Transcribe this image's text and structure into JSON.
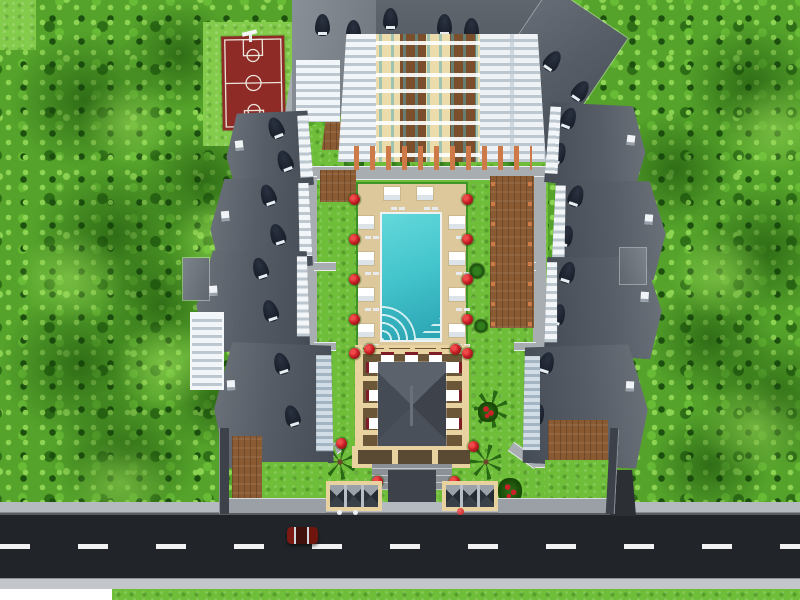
{
  "scene": {
    "title": "Aerial 3D render of a gated residential complex",
    "description": "Top-down architectural visualization: seven dark-roofed apartment blocks arranged around a landscaped courtyard with a turquoise swimming pool, white sun loungers, red flower planters, a clubhouse pavilion ringed by a beige colonnade with tables, palm trees, two pyramid-roofed entrance pergola gates, a basketball court and a small playground among dense trees, bordered at the bottom by an asphalt street with a dashed center line and a single dark-red car.",
    "style": "3d-render",
    "time_of_day": "daytime"
  },
  "colors": {
    "foliage_base": "#55a32b",
    "foliage_light": "#8ed453",
    "foliage_mid": "#67bb35",
    "foliage_dark": "#2e6e16",
    "foliage_deep": "#1d5110",
    "grass": "#6fbe3a",
    "grass_light": "#83cb4a",
    "court_red": "#8f2b26",
    "court_line": "#ece7dc",
    "roof_dark": "#575d66",
    "dormer": "#1a202b",
    "facade_cream": "#ecdcab",
    "facade_brown": "#7b4f2b",
    "facade_shadow": "#bcc7d0",
    "terracotta": "#cd7a48",
    "wood": "#8a5a33",
    "pool_deck": "#dcc89a",
    "deck_edge": "#3f9428",
    "pool_water": "#45c6cd",
    "pool_water_deep": "#2aa3b2",
    "path": "#a8adb2",
    "path_edge": "#e9ebee",
    "beige": "#e8d2a0",
    "maroon": "#7e1d26",
    "flower": "#cc2128",
    "flower_dark": "#7e1313",
    "road": "#212529",
    "road_line": "#f2f2f2",
    "sidewalk": "#b5bac0",
    "sidewalk_light": "#c3c7cc",
    "wall": "#9aa0a6",
    "wall_dark": "#3d424a",
    "car": "#6f150e",
    "white": "#ffffff"
  },
  "objects": {
    "basketball_court": {
      "location": "top-left",
      "surface_color": "#8f2b26",
      "markings": [
        "boundary",
        "half-court line",
        "center circle",
        "two keys with free-throw circles"
      ]
    },
    "playground": {
      "location": "top-right",
      "pad_color": "#f6f3ee",
      "slide_color": "#d84848"
    },
    "swimming_pool": {
      "shape": "rectangle",
      "water_color": "#45c6cd",
      "coping": "white",
      "features": [
        "quarter-circle fan entry steps",
        "corner steps"
      ]
    },
    "sun_loungers": {
      "count": 10,
      "color": "#ffffff"
    },
    "flower_planters": {
      "count": 16,
      "color": "#cc2128"
    },
    "palm_trees": {
      "count": 3
    },
    "small_trees": {
      "count": 2
    },
    "residential_buildings": {
      "count": 7,
      "roof_color": "#575d66",
      "dormers": true,
      "balconies": "white"
    },
    "clubhouse": {
      "roof": "dark hip roof",
      "colonnade_color": "#e8d2a0",
      "tables": 9
    },
    "entrance_gates": {
      "count": 2,
      "style": "pergola with pyramid caps",
      "frame_color": "#e8d2a0"
    },
    "road": {
      "surface": "#212529",
      "marking": "white dashed center line",
      "sidewalks": 2
    },
    "vehicles": {
      "count": 1,
      "color": "#6f150e",
      "location": "left of center on road"
    }
  }
}
